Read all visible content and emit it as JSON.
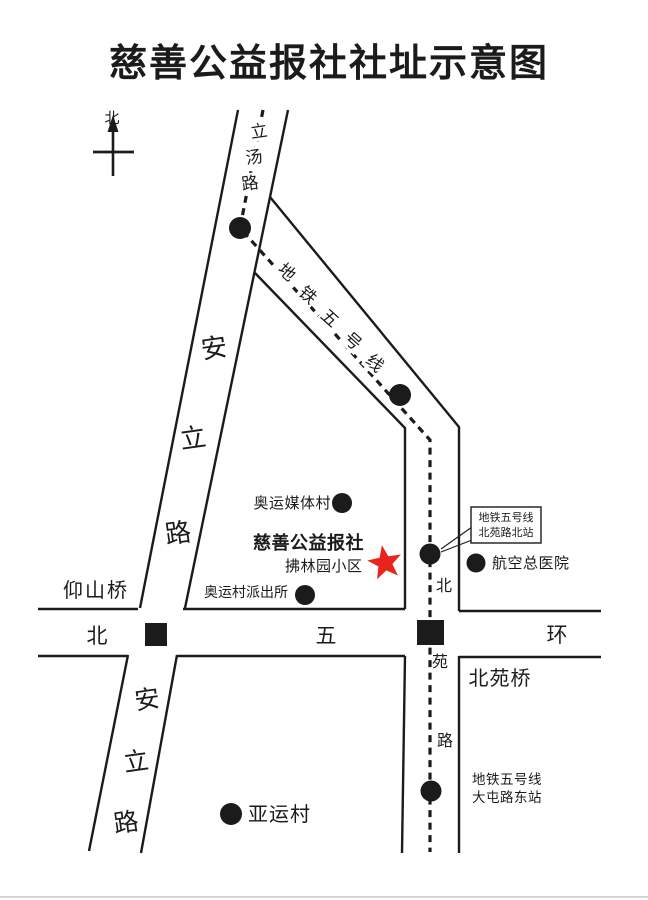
{
  "title": "慈善公益报社社址示意图",
  "colors": {
    "ink": "#1b1b1b",
    "red": "#e8241c"
  },
  "compass": {
    "north_label": "北"
  },
  "roads": {
    "litang": {
      "name": "立汤路",
      "chars": [
        "立",
        "汤",
        "路"
      ]
    },
    "subway5": {
      "name": "地铁五号线",
      "chars": [
        "地",
        "铁",
        "五",
        "号",
        "线"
      ]
    },
    "anli_upper": {
      "name": "安立路",
      "chars": [
        "安",
        "立",
        "路"
      ]
    },
    "anli_lower": {
      "name": "安立路",
      "chars": [
        "安",
        "立",
        "路"
      ]
    },
    "beiyuan": {
      "name": "北苑路",
      "chars": [
        "北",
        "苑",
        "路"
      ]
    },
    "ring5": {
      "name": "北五环",
      "chars": [
        "北",
        "五",
        "环"
      ]
    }
  },
  "landmarks": {
    "media_village": "奥运媒体村",
    "office": "慈善公益报社",
    "fulinyuan": "拂林园小区",
    "police_station": "奥运村派出所",
    "yangshan_bridge": "仰山桥",
    "hospital": "航空总医院",
    "beiyuan_bridge": "北苑桥",
    "asian_games_village": "亚运村"
  },
  "stations": {
    "beiyuan_north": {
      "line1": "地铁五号线",
      "line2": "北苑路北站"
    },
    "datun_east": {
      "line1": "地铁五号线",
      "line2": "大屯路东站"
    }
  }
}
